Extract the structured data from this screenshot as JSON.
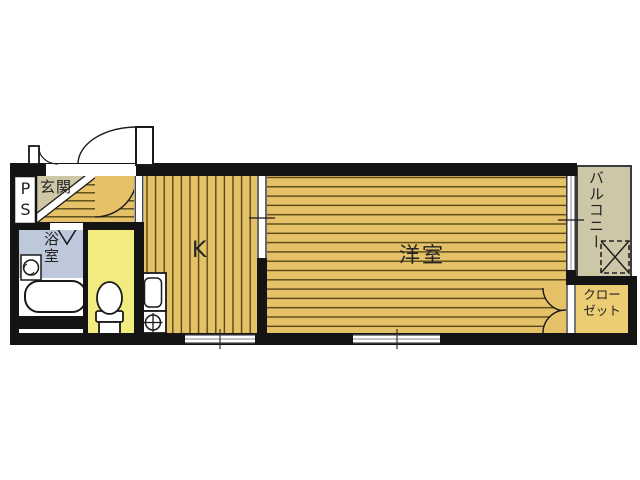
{
  "title": "apartment-floor-plan",
  "floorplan": {
    "rooms": {
      "entrance": {
        "label": "玄関"
      },
      "pipe_space": {
        "label": "PS"
      },
      "bathroom": {
        "label": "浴室"
      },
      "kitchen": {
        "label": "K"
      },
      "western_room": {
        "label": "洋室"
      },
      "balcony": {
        "label": "バルコニー"
      },
      "closet": {
        "label": "クロー\nゼット"
      }
    },
    "fixtures": [
      "entrance-door",
      "meter-box-door",
      "bathtub",
      "washing-machine",
      "bathroom-folding-door",
      "toilet",
      "kitchen-sink",
      "gas-stove",
      "sliding-partition",
      "kitchen-window",
      "room-window",
      "balcony-window",
      "closet-double-doors",
      "laundry-machine-space"
    ],
    "colors": {
      "wall": "#141414",
      "floor": "#e5c167",
      "stripe": "#55471a",
      "beige": "#cdc6a7",
      "bath": "#bdc8da",
      "toilet": "#f1ec7d",
      "closet": "#eccd74",
      "line": "#1a1a1a",
      "paper": "#ffffff"
    }
  }
}
